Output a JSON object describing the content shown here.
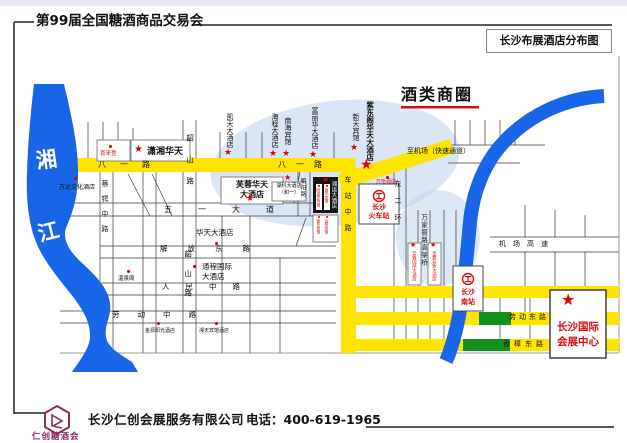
{
  "header": {
    "title_left": "第99届全国糖酒商品交易会",
    "title_right": "长沙布展酒店分布图"
  },
  "map": {
    "business_circle_label": "酒类商圈",
    "airport_note": "至机场（快速通道）",
    "river": {
      "char1": "湘",
      "char2": "江"
    },
    "roads": {
      "bayi": "八一路",
      "wuyi": "五一大道",
      "jiefang": "解放东路",
      "renmin": "人民中路",
      "laodong_middle": "劳动中路",
      "laodong_east": "劳动东路",
      "xiangzhang_east": "香樟东路",
      "shaoshan": "韶山路",
      "caie": "蔡锷中路",
      "chaoyang": "朝阳路",
      "chezhan": "车站中路",
      "erhuan": "东二环",
      "wanjiali": "万家丽路高架桥",
      "jichang_gaosu": "机场高速"
    },
    "stations": {
      "main": {
        "l1": "长沙",
        "l2": "火车站"
      },
      "south": {
        "l1": "长沙",
        "l2": "南站"
      }
    },
    "venue": {
      "l1": "长沙国际",
      "l2": "会展中心"
    },
    "hotels": {
      "star": [
        {
          "name": "潇湘华天"
        },
        {
          "name": "凯天大酒店"
        },
        {
          "name": "海程大酒店"
        },
        {
          "name": "南海宾馆"
        },
        {
          "name": "富丽华大酒店"
        },
        {
          "name": "新天宾馆"
        },
        {
          "name": "紫东阁华天大酒店"
        },
        {
          "name": "芙蓉华天",
          "name2": "大酒店"
        },
        {
          "name": "湖科大酒店",
          "name2": "（和一）"
        },
        {
          "name": "湘运大酒店"
        },
        {
          "name": "华雅国际大酒店"
        },
        {
          "name": "圣爵菲斯大酒店"
        }
      ],
      "dot": [
        {
          "name": "喜来登"
        },
        {
          "name": "万达文化酒店"
        },
        {
          "name": "华天大酒店"
        },
        {
          "name": "通程国际",
          "name2": "大酒店"
        },
        {
          "name": "温泉阁"
        },
        {
          "name": "金源阳光酒店"
        },
        {
          "name": "湘天宾馆酒店"
        },
        {
          "name": "万怡酒店"
        },
        {
          "name": "阿波罗宾馆"
        },
        {
          "name": "银华宾馆"
        },
        {
          "name": "紫金宾馆"
        },
        {
          "name": "站前宾馆"
        }
      ]
    }
  },
  "footer": {
    "logo_text": "仁创糖酒会",
    "company": "长沙仁创会展服务有限公司",
    "phone": "电话：400-619-1965"
  },
  "icons": {
    "star": "★"
  },
  "colors": {
    "road_yellow": "#ffe400",
    "river_blue": "#1865e8",
    "green_segment": "#12921c",
    "accent_red": "#d40f0f",
    "pale_circle": "#bcd2ec",
    "logo_maroon": "#8c2b5c"
  }
}
